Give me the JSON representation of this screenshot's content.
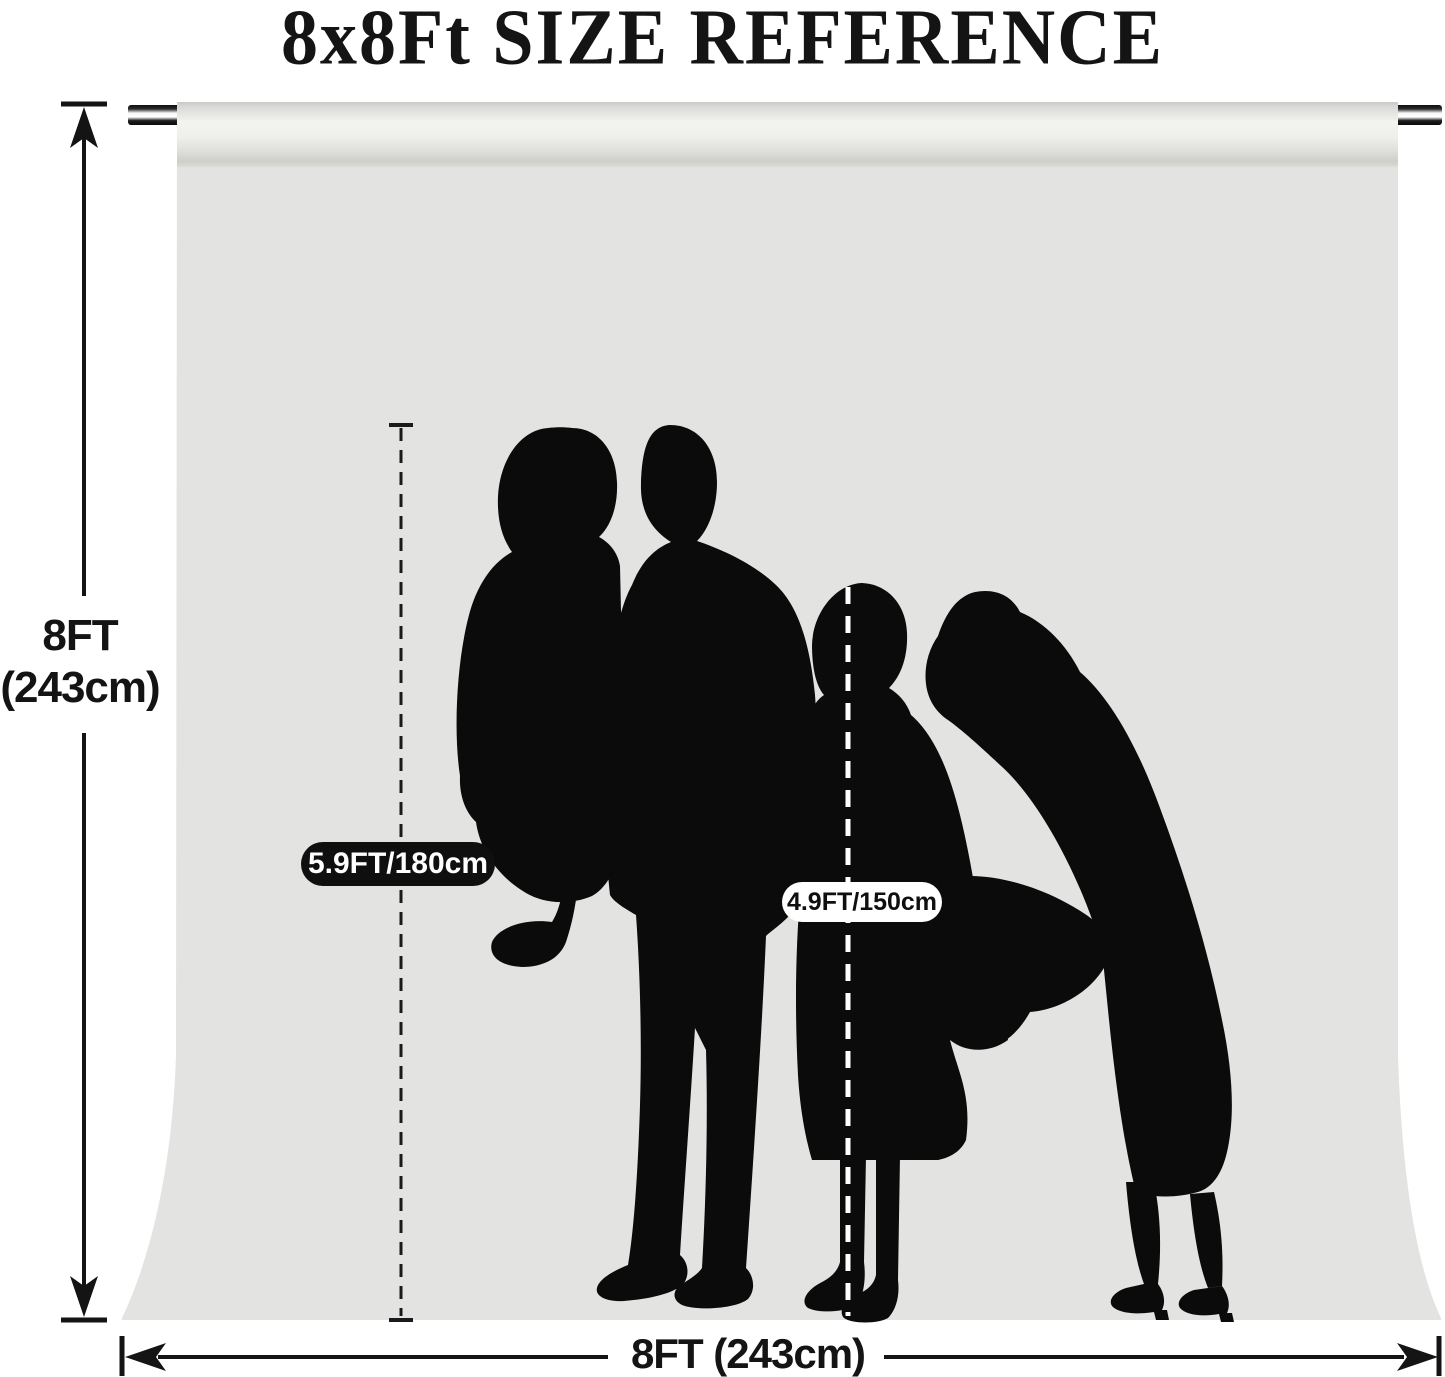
{
  "title": "8x8Ft SIZE REFERENCE",
  "backdrop": {
    "height_label_line1": "8FT",
    "height_label_line2": "(243cm)",
    "width_label": "8FT (243cm)"
  },
  "markers": {
    "adult_height": "5.9FT/180cm",
    "child_height": "4.9FT/150cm"
  },
  "silhouettes": [
    "father-holding-toddler-silhouette",
    "girl-silhouette",
    "mother-bending-silhouette"
  ],
  "colors": {
    "backdrop_gray": "#e3e3e1",
    "backdrop_roll_highlight": "#f3f3f0",
    "backdrop_roll_shadow": "#cfcfca",
    "silhouette_black": "#0b0b0b",
    "rod_dark": "#0d0d0d",
    "text_black": "#141414",
    "adult_pill_bg": "#0f0f0f",
    "adult_pill_text": "#ffffff",
    "child_pill_bg": "#ffffff",
    "child_pill_text": "#0f0f0f"
  }
}
